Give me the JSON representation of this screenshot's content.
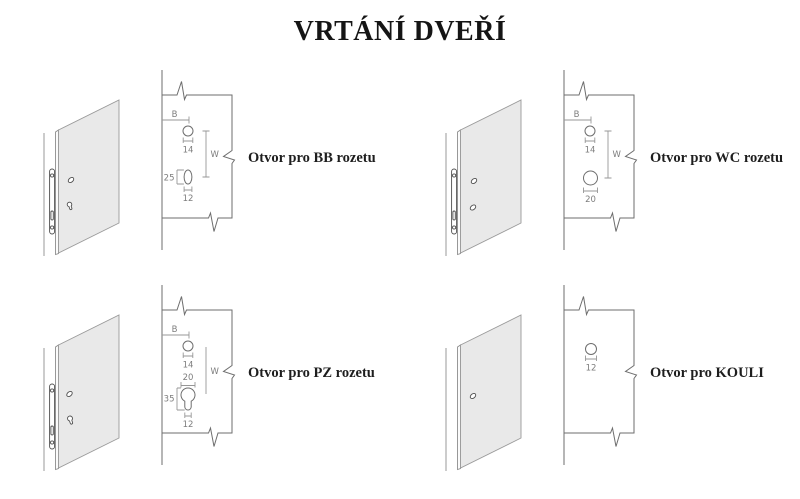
{
  "title": "VRTÁNÍ DVEŘÍ",
  "colors": {
    "door_face": "#e9e9e9",
    "drawing_line": "#6e6e6e",
    "dimension_line": "#979797",
    "dimension_text": "#7d7d7d",
    "label_text": "#1e1e1e"
  },
  "panels": [
    {
      "id": "bb",
      "label": "Otvor pro BB rozetu",
      "b": "B",
      "w": "W",
      "spindle": "14",
      "lock_height": "25",
      "lock_width": "12"
    },
    {
      "id": "wc",
      "label": "Otvor pro WC rozetu",
      "b": "B",
      "w": "W",
      "spindle": "14",
      "wc_hole": "20"
    },
    {
      "id": "pz",
      "label": "Otvor pro PZ rozetu",
      "b": "B",
      "w": "W",
      "spindle": "14",
      "cyl_width": "20",
      "cyl_height": "35",
      "cyl_slot": "12"
    },
    {
      "id": "kouli",
      "label": "Otvor pro KOULI",
      "knob_hole": "12"
    }
  ]
}
